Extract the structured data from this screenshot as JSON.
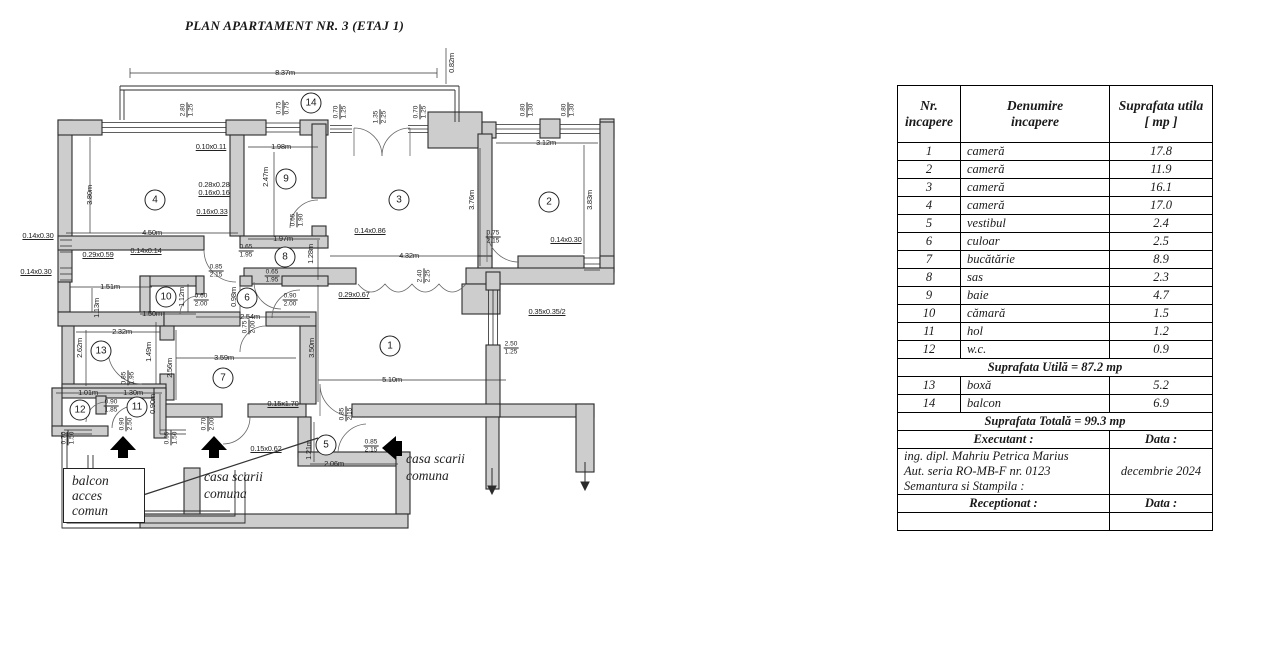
{
  "title": "PLAN APARTAMENT NR. 3 (ETAJ 1)",
  "plan": {
    "rooms": [
      {
        "n": "1",
        "x": 390,
        "y": 346
      },
      {
        "n": "2",
        "x": 549,
        "y": 202
      },
      {
        "n": "3",
        "x": 399,
        "y": 200
      },
      {
        "n": "4",
        "x": 155,
        "y": 200
      },
      {
        "n": "5",
        "x": 326,
        "y": 445
      },
      {
        "n": "6",
        "x": 247,
        "y": 298
      },
      {
        "n": "7",
        "x": 223,
        "y": 378
      },
      {
        "n": "8",
        "x": 285,
        "y": 257
      },
      {
        "n": "9",
        "x": 286,
        "y": 179
      },
      {
        "n": "10",
        "x": 166,
        "y": 297
      },
      {
        "n": "11",
        "x": 137,
        "y": 407
      },
      {
        "n": "12",
        "x": 80,
        "y": 410
      },
      {
        "n": "13",
        "x": 101,
        "y": 351
      },
      {
        "n": "14",
        "x": 311,
        "y": 103
      }
    ],
    "dims": [
      {
        "t": "8.37m",
        "x": 285,
        "y": 73
      },
      {
        "t": "0.82m",
        "x": 452,
        "y": 63,
        "o": "v"
      },
      {
        "t": "3.12m",
        "x": 546,
        "y": 143
      },
      {
        "t": "0.10x0.11",
        "x": 211,
        "y": 147,
        "u": true
      },
      {
        "t": "1.98m",
        "x": 281,
        "y": 147
      },
      {
        "t": "2.47m",
        "x": 266,
        "y": 177,
        "o": "v"
      },
      {
        "t": "3.80m",
        "x": 90,
        "y": 195,
        "o": "v"
      },
      {
        "t": "0.28x0.28",
        "x": 214,
        "y": 185
      },
      {
        "t": "0.16x0.16",
        "x": 214,
        "y": 193,
        "u": true
      },
      {
        "t": "0.16x0.33",
        "x": 212,
        "y": 212,
        "u": true
      },
      {
        "t": "4.50m",
        "x": 152,
        "y": 233
      },
      {
        "t": "1.97m",
        "x": 283,
        "y": 239
      },
      {
        "t": "0.14x0.86",
        "x": 370,
        "y": 231,
        "u": true
      },
      {
        "t": "0.14x0.30",
        "x": 566,
        "y": 240,
        "u": true
      },
      {
        "t": "3.76m",
        "x": 472,
        "y": 200,
        "o": "v"
      },
      {
        "t": "3.83m",
        "x": 590,
        "y": 200,
        "o": "v"
      },
      {
        "t": "0.14x0.30",
        "x": 38,
        "y": 236,
        "u": true
      },
      {
        "t": "0.14x0.30",
        "x": 36,
        "y": 272,
        "u": true
      },
      {
        "t": "0.29x0.59",
        "x": 98,
        "y": 255,
        "u": true
      },
      {
        "t": "0.14x0.14",
        "x": 146,
        "y": 251,
        "u": true
      },
      {
        "t": "4.32m",
        "x": 409,
        "y": 256
      },
      {
        "t": "0.29x0.67",
        "x": 354,
        "y": 295,
        "u": true
      },
      {
        "t": "1.28m",
        "x": 311,
        "y": 254,
        "o": "v"
      },
      {
        "t": "1.51m",
        "x": 110,
        "y": 287
      },
      {
        "t": "1.13m",
        "x": 97,
        "y": 308,
        "o": "v"
      },
      {
        "t": "1.50m",
        "x": 152,
        "y": 314
      },
      {
        "t": "1.12m",
        "x": 182,
        "y": 297,
        "o": "v"
      },
      {
        "t": "0.98m",
        "x": 234,
        "y": 297,
        "o": "v"
      },
      {
        "t": "2.54m",
        "x": 250,
        "y": 317
      },
      {
        "t": "0.35x0.35/2",
        "x": 547,
        "y": 312,
        "u": true
      },
      {
        "t": "2.32m",
        "x": 122,
        "y": 332
      },
      {
        "t": "2.62m",
        "x": 80,
        "y": 348,
        "o": "v"
      },
      {
        "t": "1.49m",
        "x": 149,
        "y": 352,
        "o": "v"
      },
      {
        "t": "3.59m",
        "x": 224,
        "y": 358
      },
      {
        "t": "2.56m",
        "x": 170,
        "y": 368,
        "o": "v"
      },
      {
        "t": "3.50m",
        "x": 312,
        "y": 348,
        "o": "v"
      },
      {
        "t": "5.10m",
        "x": 392,
        "y": 380
      },
      {
        "t": "0.15x1.70",
        "x": 283,
        "y": 404,
        "u": true
      },
      {
        "t": "1.01m",
        "x": 88,
        "y": 393
      },
      {
        "t": "1.30m",
        "x": 133,
        "y": 393
      },
      {
        "t": "0.90m",
        "x": 153,
        "y": 404,
        "o": "v"
      },
      {
        "t": "0.15x0.62",
        "x": 266,
        "y": 449,
        "u": true
      },
      {
        "t": "1.21m",
        "x": 309,
        "y": 450,
        "o": "v"
      },
      {
        "t": "2.06m",
        "x": 334,
        "y": 464
      }
    ],
    "fracs": [
      {
        "a": "2.80",
        "b": "1.25",
        "x": 187,
        "y": 110,
        "o": "v"
      },
      {
        "a": "0.75",
        "b": "0.75",
        "x": 283,
        "y": 108,
        "o": "v"
      },
      {
        "a": "0.70",
        "b": "1.25",
        "x": 340,
        "y": 112,
        "o": "v"
      },
      {
        "a": "1.35",
        "b": "2.25",
        "x": 380,
        "y": 117,
        "o": "v"
      },
      {
        "a": "0.70",
        "b": "1.25",
        "x": 420,
        "y": 112,
        "o": "v"
      },
      {
        "a": "0.80",
        "b": "1.30",
        "x": 527,
        "y": 110,
        "o": "v"
      },
      {
        "a": "0.80",
        "b": "1.30",
        "x": 568,
        "y": 110,
        "o": "v"
      },
      {
        "a": "0.65",
        "b": "1.90",
        "x": 297,
        "y": 220,
        "o": "v"
      },
      {
        "a": "0.75",
        "b": "2.15",
        "x": 493,
        "y": 237
      },
      {
        "a": "0.65",
        "b": "1.95",
        "x": 246,
        "y": 251
      },
      {
        "a": "0.85",
        "b": "2.15",
        "x": 216,
        "y": 271
      },
      {
        "a": "0.65",
        "b": "1.95",
        "x": 272,
        "y": 276
      },
      {
        "a": "2.40",
        "b": "2.25",
        "x": 424,
        "y": 276,
        "o": "v"
      },
      {
        "a": "0.60",
        "b": "2.00",
        "x": 201,
        "y": 300
      },
      {
        "a": "0.90",
        "b": "2.00",
        "x": 290,
        "y": 300
      },
      {
        "a": "0.75",
        "b": "2.00",
        "x": 249,
        "y": 327,
        "o": "v"
      },
      {
        "a": "2.50",
        "b": "1.25",
        "x": 511,
        "y": 348
      },
      {
        "a": "0.85",
        "b": "1.95",
        "x": 128,
        "y": 378,
        "o": "v"
      },
      {
        "a": "0.90",
        "b": "1.85",
        "x": 111,
        "y": 406
      },
      {
        "a": "0.90",
        "b": "2.50",
        "x": 126,
        "y": 424,
        "o": "v"
      },
      {
        "a": "0.70",
        "b": "1.50",
        "x": 68,
        "y": 438,
        "o": "v"
      },
      {
        "a": "0.65",
        "b": "1.50",
        "x": 171,
        "y": 438,
        "o": "v"
      },
      {
        "a": "0.70",
        "b": "2.00",
        "x": 208,
        "y": 424,
        "o": "v"
      },
      {
        "a": "0.85",
        "b": "2.15",
        "x": 346,
        "y": 414,
        "o": "v"
      },
      {
        "a": "0.85",
        "b": "2.15",
        "x": 371,
        "y": 446
      }
    ],
    "notes": {
      "stair_left_1": "casa scarii",
      "stair_left_2": "comuna",
      "stair_right_1": "casa scarii",
      "stair_right_2": "comuna",
      "balcony_1": "balcon",
      "balcony_2": "acces",
      "balcony_3": "comun"
    }
  },
  "table": {
    "headers": [
      [
        "Nr.",
        "incapere"
      ],
      [
        "Denumire",
        "incapere"
      ],
      [
        "Suprafata utila",
        "[ mp ]"
      ]
    ],
    "rows": [
      {
        "nr": "1",
        "name": "cameră",
        "area": "17.8"
      },
      {
        "nr": "2",
        "name": "cameră",
        "area": "11.9"
      },
      {
        "nr": "3",
        "name": "cameră",
        "area": "16.1"
      },
      {
        "nr": "4",
        "name": "cameră",
        "area": "17.0"
      },
      {
        "nr": "5",
        "name": "vestibul",
        "area": "2.4"
      },
      {
        "nr": "6",
        "name": "culoar",
        "area": "2.5"
      },
      {
        "nr": "7",
        "name": "bucătărie",
        "area": "8.9"
      },
      {
        "nr": "8",
        "name": "sas",
        "area": "2.3"
      },
      {
        "nr": "9",
        "name": "baie",
        "area": "4.7"
      },
      {
        "nr": "10",
        "name": "cămară",
        "area": "1.5"
      },
      {
        "nr": "11",
        "name": "hol",
        "area": "1.2"
      },
      {
        "nr": "12",
        "name": "w.c.",
        "area": "0.9"
      },
      {
        "span": "Suprafata Utilă = 87.2 mp"
      },
      {
        "nr": "13",
        "name": "boxă",
        "area": "5.2"
      },
      {
        "nr": "14",
        "name": "balcon",
        "area": "6.9"
      },
      {
        "span": "Suprafata Totală = 99.3 mp"
      }
    ],
    "footer": {
      "executant_label": "Executant :",
      "data_label_1": "Data :",
      "executant_lines": [
        "ing. dipl. Mahriu Petrica Marius",
        "Aut. seria RO-MB-F nr. 0123",
        "Semantura si Stampila :"
      ],
      "date": "decembrie 2024",
      "receptionat_label": "Receptionat :",
      "data_label_2": "Data :"
    }
  }
}
